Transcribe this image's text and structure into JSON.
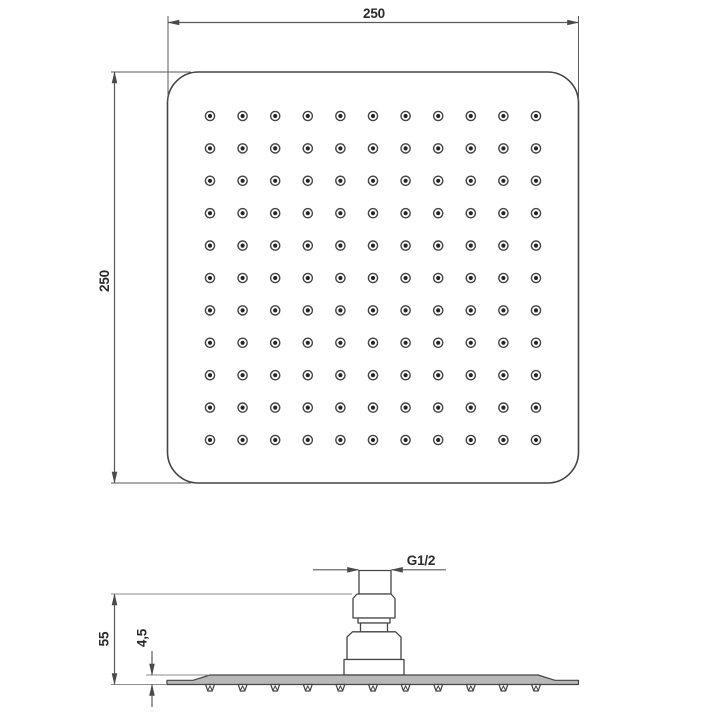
{
  "drawing": {
    "colors": {
      "bg": "#ffffff",
      "line": "#454545",
      "dim": "#5a5a5a",
      "ext": "#8e8e8e",
      "text": "#2b2b2b",
      "section": "#b8b8b8",
      "dot": "#262626"
    },
    "top_view": {
      "width_label": "250",
      "height_label": "250",
      "nozzle_rows": 11,
      "nozzle_cols": 11
    },
    "side_view": {
      "height_label": "55",
      "plate_thickness_label": "4,5",
      "thread_label": "G1/2",
      "nozzle_count": 11
    }
  }
}
